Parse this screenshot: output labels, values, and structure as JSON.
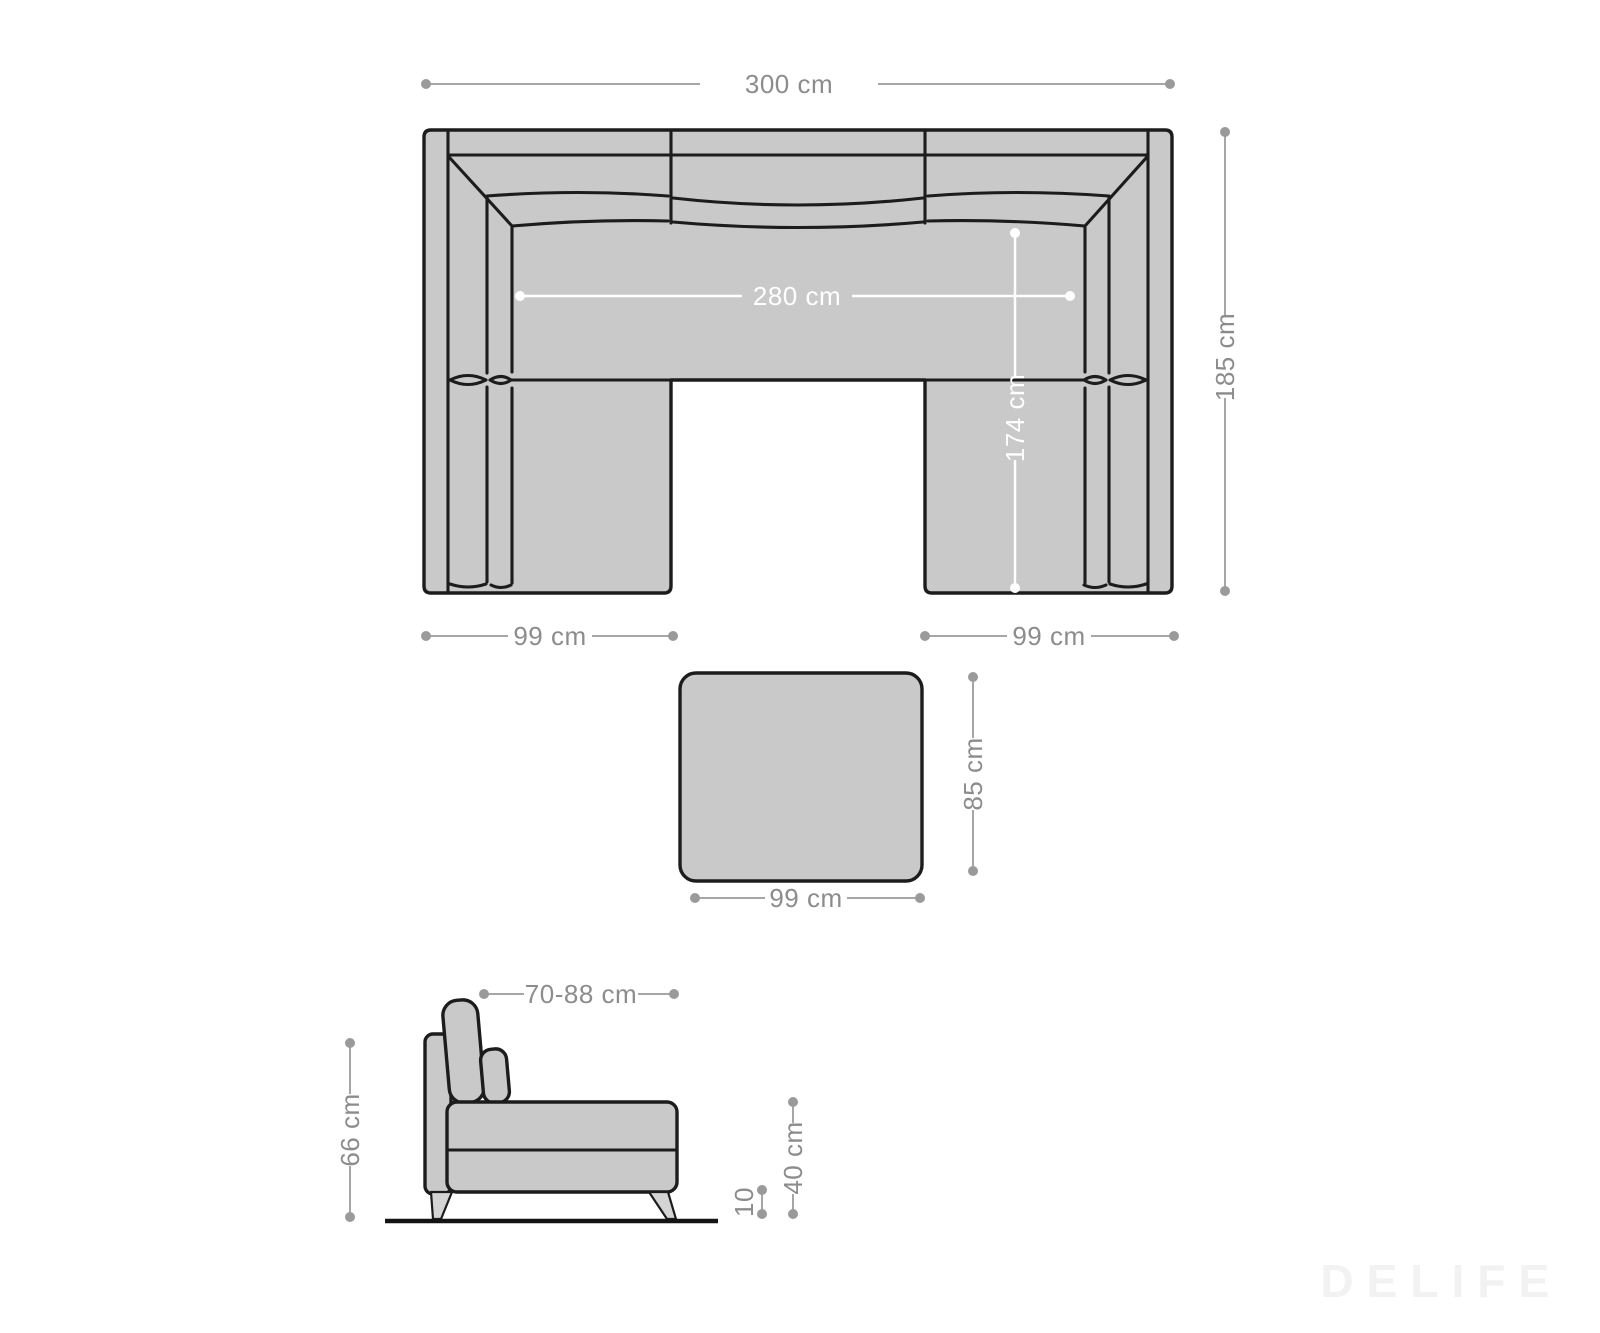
{
  "page": {
    "background": "#ffffff"
  },
  "colors": {
    "furniture_fill": "#c9c9c9",
    "outline": "#1c1c1c",
    "leg_fill": "#d4d4d4",
    "dimension_line": "#a6a6a6",
    "dimension_text": "#8c8c8c",
    "dimension_white": "#ffffff",
    "watermark_gray": "#f2f2f2"
  },
  "sofa_top_view": {
    "description": "U-shaped sofa seen from above",
    "overall_width": "300 cm",
    "overall_depth": "185 cm",
    "inner_width": "280 cm",
    "inner_depth": "174 cm",
    "left_element_width": "99 cm",
    "right_element_width": "99 cm"
  },
  "ottoman_top_view": {
    "description": "Square ottoman seen from above",
    "depth": "85 cm",
    "width": "99 cm"
  },
  "sofa_side_view": {
    "description": "Sofa seen from the side",
    "depth_range": "70-88 cm",
    "total_height": "66 cm",
    "seat_height": "40 cm",
    "leg_height": "10"
  },
  "watermark": {
    "text": "DELIFE"
  }
}
